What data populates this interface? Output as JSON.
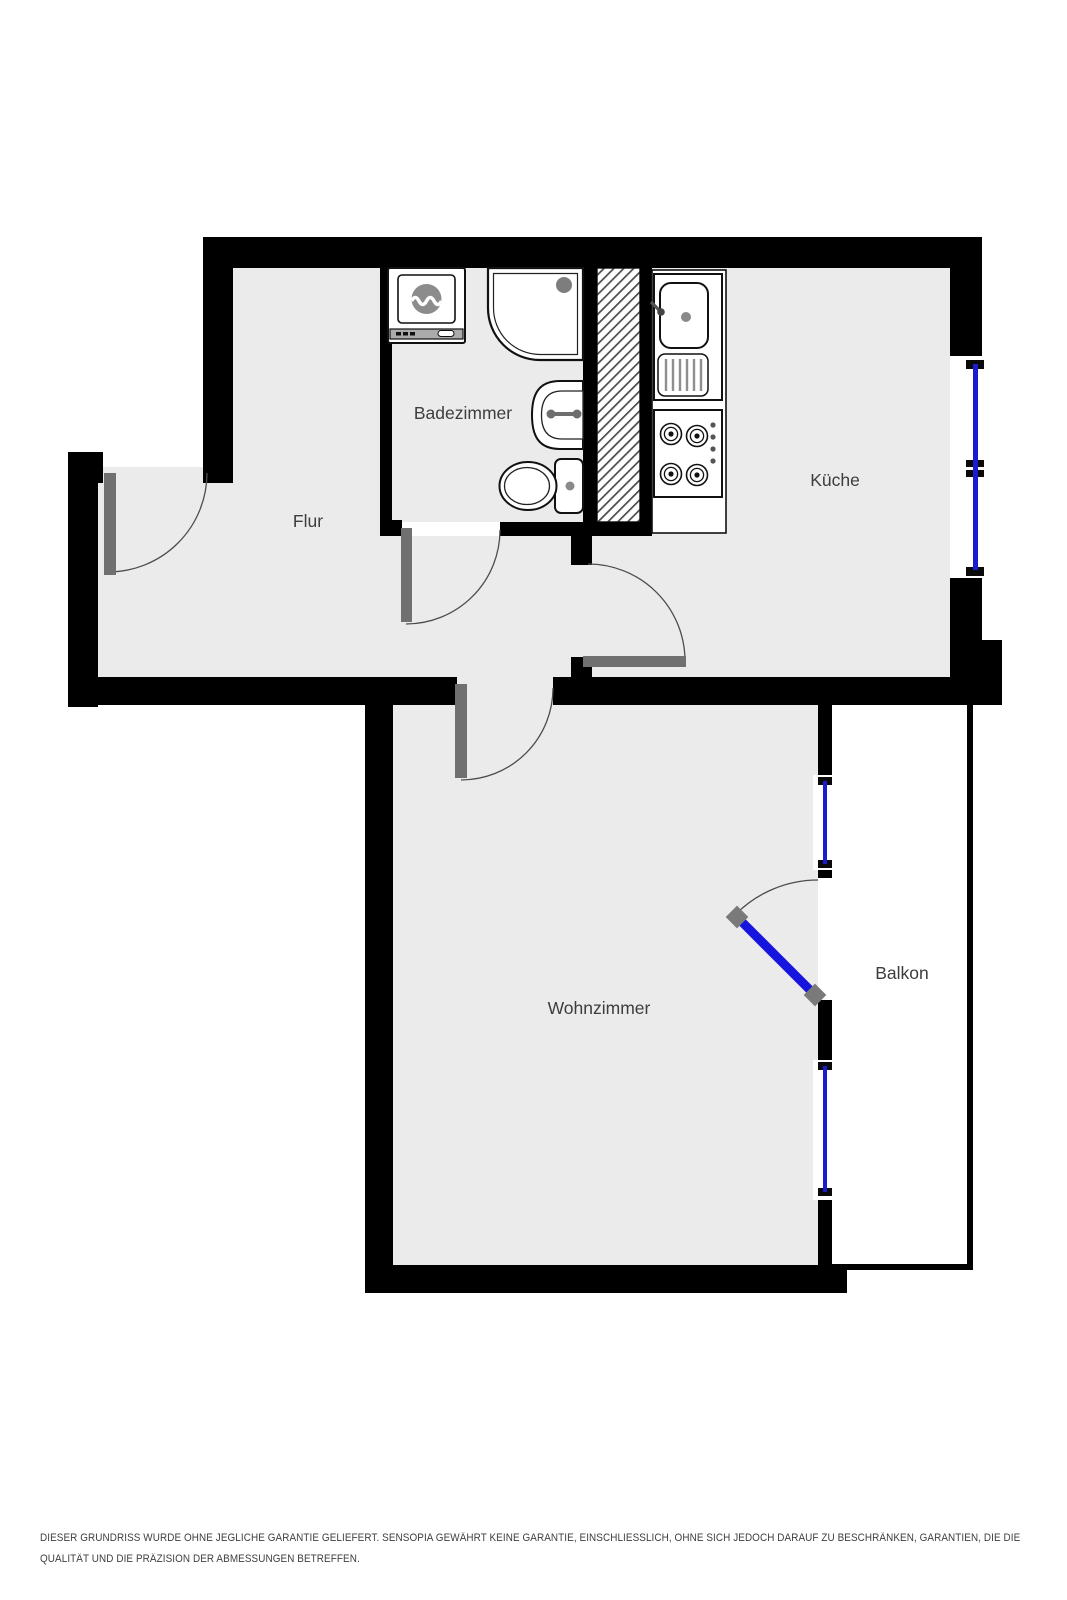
{
  "floorplan": {
    "rooms": [
      {
        "name": "Badezimmer"
      },
      {
        "name": "Flur"
      },
      {
        "name": "Küche"
      },
      {
        "name": "Wohnzimmer"
      },
      {
        "name": "Balkon"
      }
    ],
    "colors": {
      "wall": "#000000",
      "floor": "#ebebeb",
      "door_leaf": "#707070",
      "window_glass": "#1b1bd0",
      "balcony_door_leaf": "#1515dd",
      "label_text": "#3d3d3d",
      "hatch_line": "#4a4a4a"
    },
    "disclaimer": {
      "line1": "DIESER GRUNDRISS WURDE OHNE JEGLICHE GARANTIE GELIEFERT. SENSOPIA GEWÄHRT KEINE GARANTIE, EINSCHLIESSLICH, OHNE SICH JEDOCH DARAUF ZU BESCHRÄNKEN, GARANTIEN, DIE DIE",
      "line2": "QUALITÄT UND DIE PRÄZISION DER ABMESSUNGEN BETREFFEN."
    }
  }
}
